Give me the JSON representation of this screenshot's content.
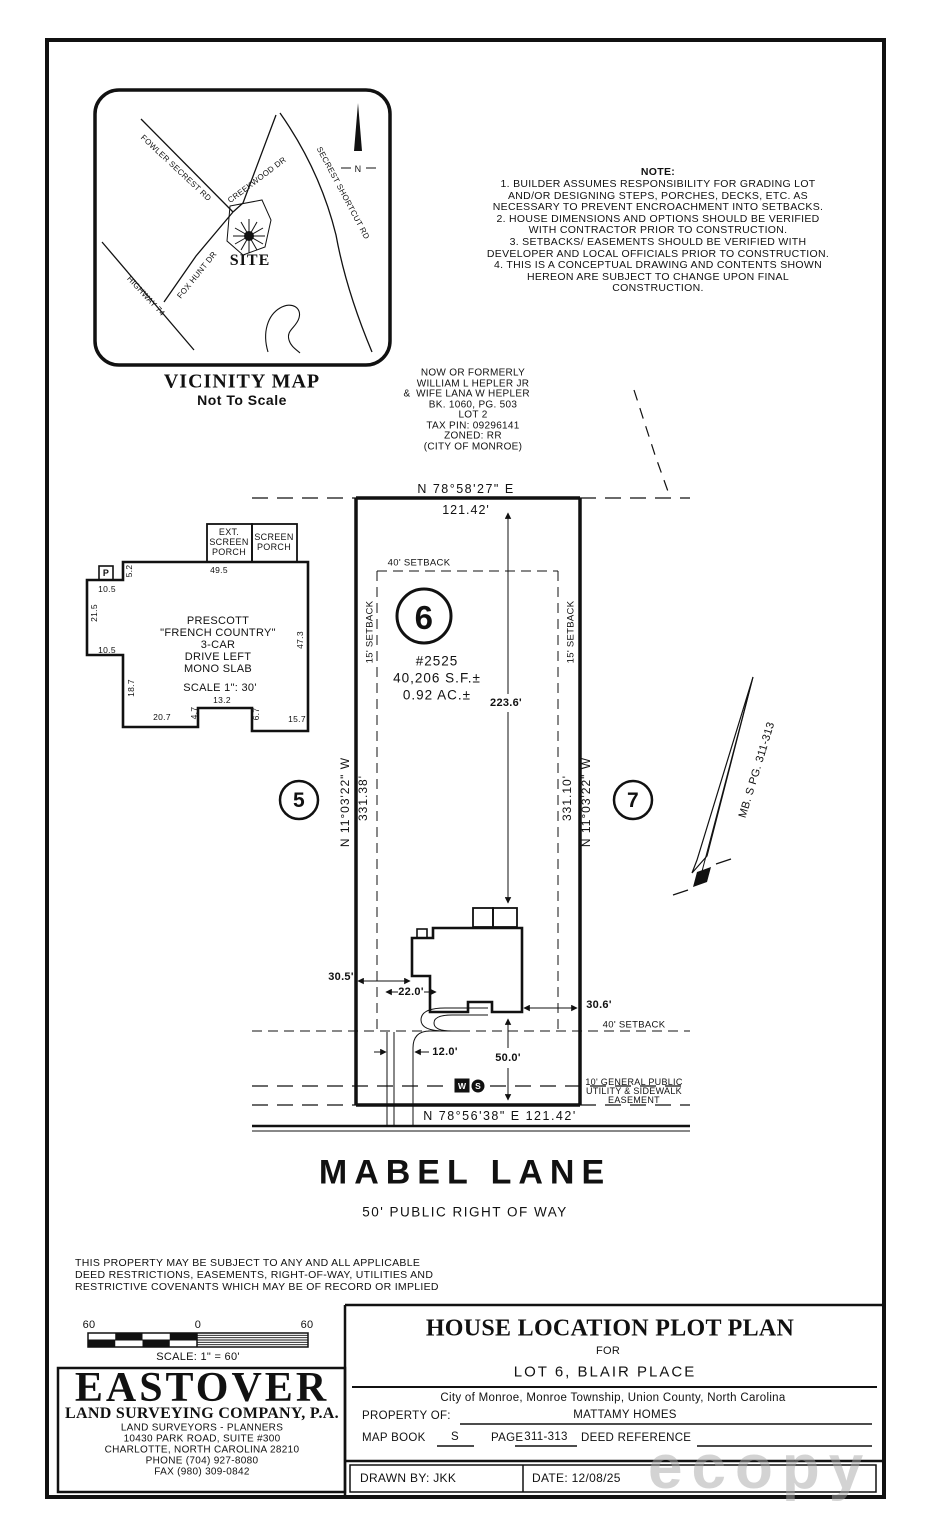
{
  "vicinity": {
    "title": "VICINITY MAP",
    "subtitle": "Not To Scale",
    "site": "SITE",
    "north": "N",
    "roads": [
      "FOWLER SECREST RD",
      "CREEKWOOD DR",
      "SECREST SHORTCUT RD",
      "FOX HUNT DR",
      "HIGHWAY 74"
    ]
  },
  "note": {
    "lines": [
      "NOTE:",
      "1. BUILDER ASSUMES RESPONSIBILITY FOR GRADING LOT",
      "AND/OR DESIGNING STEPS, PORCHES, DECKS, ETC. AS",
      "NECESSARY TO PREVENT ENCROACHMENT INTO SETBACKS.",
      "2. HOUSE DIMENSIONS AND OPTIONS SHOULD BE VERIFIED",
      "WITH CONTRACTOR PRIOR TO CONSTRUCTION.",
      "3. SETBACKS/ EASEMENTS SHOULD BE VERIFIED WITH",
      "DEVELOPER AND LOCAL OFFICIALS PRIOR TO CONSTRUCTION.",
      "4. THIS IS A CONCEPTUAL DRAWING AND CONTENTS SHOWN",
      "HEREON ARE SUBJECT TO CHANGE UPON FINAL",
      "CONSTRUCTION."
    ]
  },
  "adjoiner": {
    "amp": "&",
    "lines": [
      "NOW OR FORMERLY",
      "WILLIAM L HEPLER JR",
      "WIFE LANA W HEPLER",
      "BK. 1060, PG. 503",
      "LOT 2",
      "TAX PIN: 09296141",
      "ZONED: RR",
      "(CITY OF MONROE)"
    ]
  },
  "lot": {
    "number": "6",
    "address": "#2525",
    "area_sf": "40,206 S.F.±",
    "area_ac": "0.92 AC.±",
    "bearing_top": "N 78°58'27\" E",
    "dist_top": "121.42'",
    "bearing_bottom": "N 78°56'38\" E 121.42'",
    "bearing_left": "N 11°03'22\" W",
    "dist_left": "331.38'",
    "bearing_right": "N 11°03'22\" W",
    "dist_right": "331.10'",
    "depth": "223.6'",
    "setback_front_top": "40' SETBACK",
    "setback_front_bottom": "40' SETBACK",
    "setback_left": "15' SETBACK",
    "setback_right": "15' SETBACK",
    "lot_left": "5",
    "lot_right": "7",
    "map_ref": "MB. S PG. 311-313",
    "north": "N",
    "dim_house_left": "30.5'",
    "dim_garage": "22.0'",
    "dim_house_right": "30.6'",
    "dim_drive": "12.0'",
    "dim_front": "50.0'",
    "easement_lines": [
      "10' GENERAL PUBLIC",
      "UTILITY & SIDEWALK",
      "EASEMENT"
    ],
    "w": "W",
    "s": "S"
  },
  "house": {
    "porch_left_lines": [
      "EXT.",
      "SCREEN",
      "PORCH"
    ],
    "porch_right_lines": [
      "SCREEN",
      "PORCH"
    ],
    "p": "P",
    "name_lines": [
      "PRESCOTT",
      "\"FRENCH COUNTRY\"",
      "3-CAR",
      "DRIVE LEFT",
      "MONO SLAB"
    ],
    "scale": "SCALE 1\": 30'",
    "dims": {
      "a": "5.2",
      "b": "49.5",
      "c": "10.5",
      "d": "21.5",
      "e": "10.5",
      "f": "18.7",
      "g": "20.7",
      "h": "4.7",
      "i": "13.2",
      "j": "6.7",
      "k": "15.7",
      "l": "47.3"
    }
  },
  "street": {
    "name": "MABEL LANE",
    "row": "50' PUBLIC RIGHT OF WAY"
  },
  "disclaimer": {
    "lines": [
      "THIS PROPERTY MAY BE SUBJECT TO ANY AND ALL APPLICABLE",
      "DEED RESTRICTIONS, EASEMENTS, RIGHT-OF-WAY, UTILITIES AND",
      "RESTRICTIVE COVENANTS WHICH MAY BE OF RECORD OR IMPLIED"
    ]
  },
  "scalebar": {
    "left": "60",
    "mid": "0",
    "right": "60",
    "label": "SCALE: 1\" = 60'"
  },
  "surveyor": {
    "name": "EASTOVER",
    "company": "LAND SURVEYING COMPANY, P.A.",
    "lines": [
      "LAND SURVEYORS - PLANNERS",
      "10430 PARK ROAD, SUITE #300",
      "CHARLOTTE, NORTH CAROLINA 28210",
      "PHONE (704) 927-8080",
      "FAX (980) 309-0842"
    ]
  },
  "titleblock": {
    "title": "HOUSE LOCATION PLOT PLAN",
    "for_word": "FOR",
    "lot_line": "LOT 6, BLAIR PLACE",
    "location": "City of Monroe, Monroe Township, Union County, North Carolina",
    "property_label": "PROPERTY OF:",
    "property_value": "MATTAMY HOMES",
    "map_book_label": "MAP BOOK",
    "map_book_value": "S",
    "page_label": "PAGE",
    "page_value": "311-313",
    "deed_label": "DEED REFERENCE",
    "drawn_by": "DRAWN BY: JKK",
    "date": "DATE: 12/08/25"
  },
  "watermark": "ecopy",
  "colors": {
    "ink": "#111111",
    "paper": "#ffffff",
    "watermark": "#a8a8a8"
  }
}
